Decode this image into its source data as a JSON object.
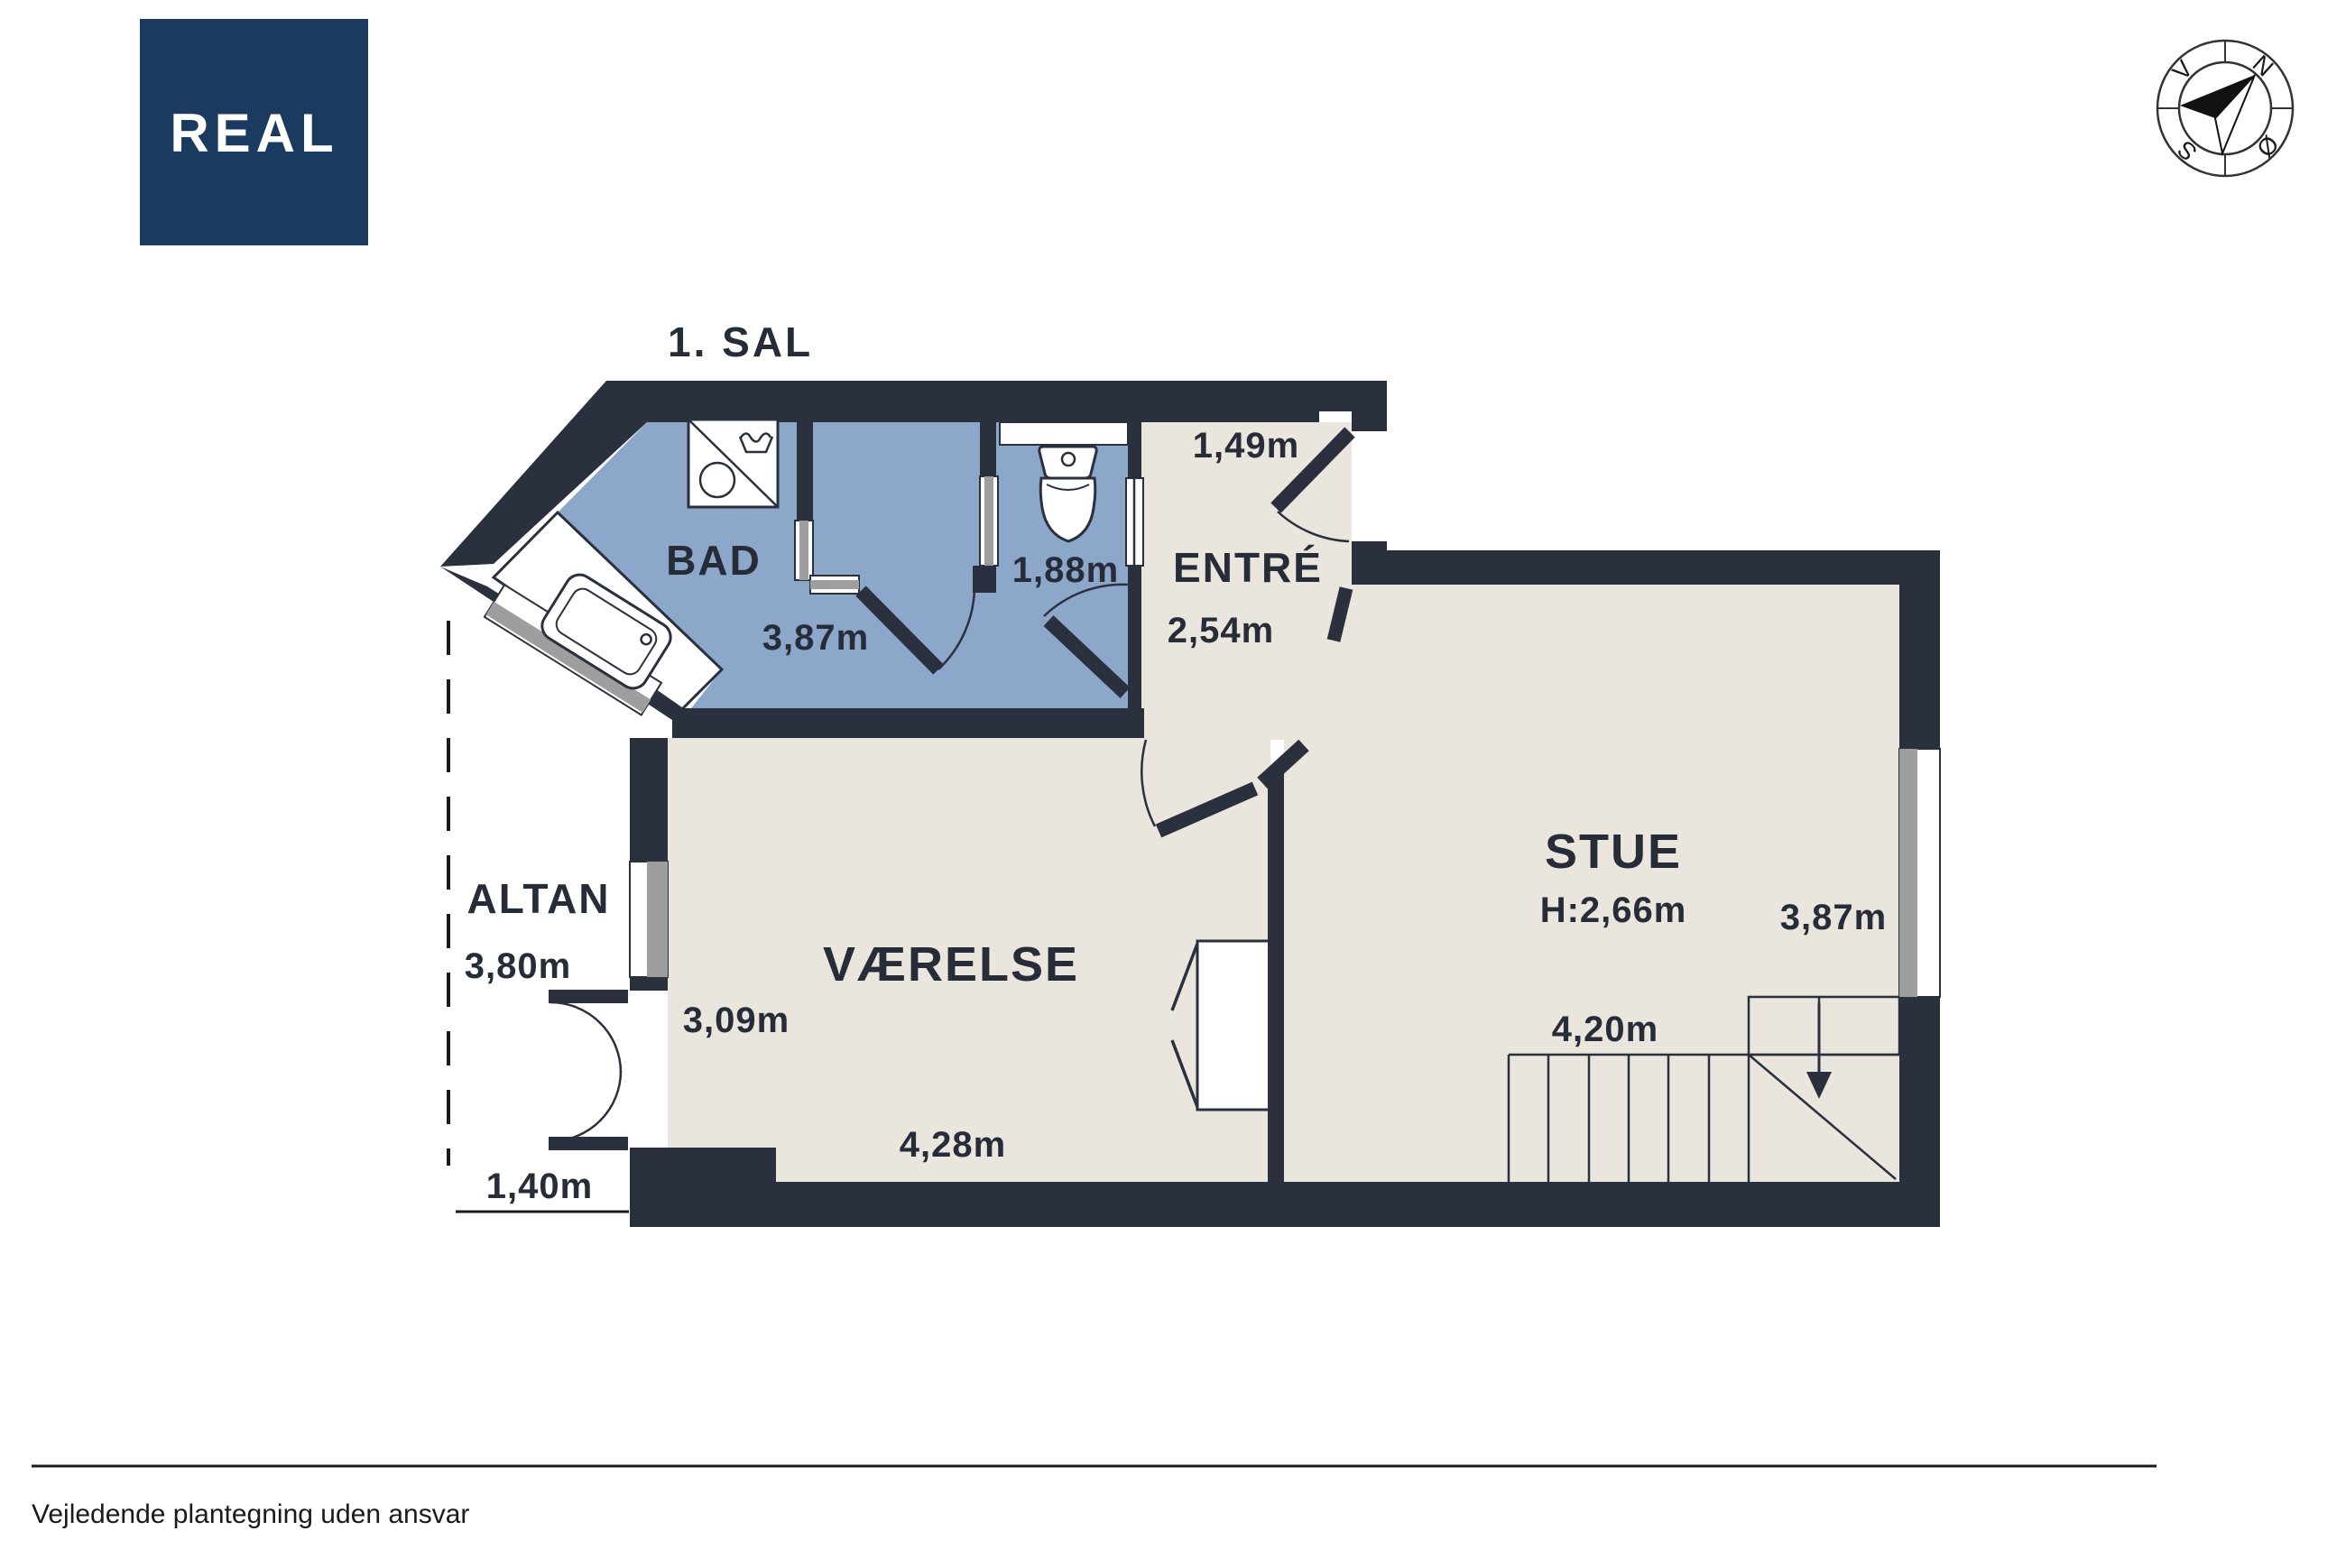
{
  "header": {
    "floor_label": "1. SAL"
  },
  "logo": {
    "text": "REAL"
  },
  "compass": {
    "n": "N",
    "e": "Ø",
    "s": "S",
    "w": "V"
  },
  "rooms": {
    "bad": {
      "label": "BAD",
      "width": "3,87m"
    },
    "wc": {
      "width": "1,88m"
    },
    "entre": {
      "label": "ENTRÉ",
      "depth": "1,49m",
      "width": "2,54m"
    },
    "stue": {
      "label": "STUE",
      "ceiling_height": "H:2,66m",
      "width": "3,87m",
      "length": "4,20m"
    },
    "vaerelse": {
      "label": "VÆRELSE",
      "width": "3,09m",
      "length": "4,28m"
    },
    "altan": {
      "label": "ALTAN",
      "width": "3,80m",
      "door_width": "1,40m"
    }
  },
  "footer": {
    "disclaimer": "Vejledende plantegning uden ansvar"
  },
  "colors": {
    "wall": "#2a303d",
    "bathroom_floor": "#8da7cb",
    "room_floor": "#eae6dd",
    "window_glass": "#9e9e9e",
    "logo_background": "#1b3a5f",
    "text_color": "#262c38"
  }
}
